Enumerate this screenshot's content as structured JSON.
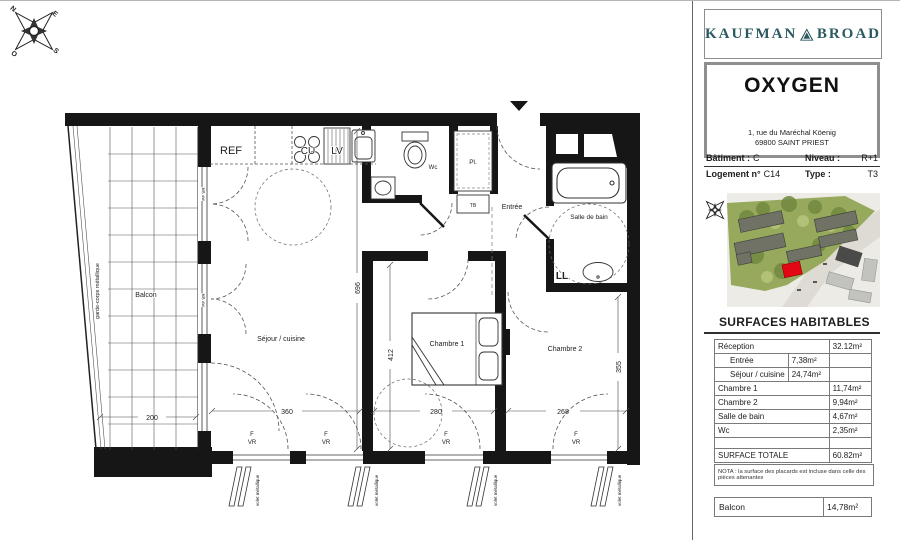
{
  "compass": {
    "n": "N",
    "e": "E",
    "s": "S",
    "o": "O"
  },
  "plan": {
    "rooms": {
      "sejour": "Séjour / cuisine",
      "chambre1": "Chambre 1",
      "chambre2": "Chambre 2",
      "salle_de_bain": "Salle de bain",
      "entree": "Entrée",
      "wc": "Wc",
      "balcon": "Balcon"
    },
    "kitchen": {
      "ref": "REF",
      "cu": "CU",
      "lv": "LV"
    },
    "fixtures": {
      "ll": "LL",
      "pl": "Pl.",
      "tb": "TB"
    },
    "window_labels": {
      "f": "F",
      "vr": "VR",
      "pf_vr": "PF VR",
      "volet": "volet métallique",
      "garde_corps": "garde-corps métallique"
    },
    "dims": {
      "balcon_w": "200",
      "sejour_w": "360",
      "sejour_h": "696",
      "ch1_w": "280",
      "ch1_h": "412",
      "ch2_w": "268",
      "ch2_h": "355"
    }
  },
  "panel": {
    "brand": {
      "left": "KAUFMAN",
      "right": "BROAD"
    },
    "residence": {
      "name": "OXYGEN",
      "address_line1": "1, rue du Maréchal Köenig",
      "address_line2": "69800 SAINT PRIEST"
    },
    "info": {
      "batiment_label": "Bâtiment :",
      "batiment_value": "C",
      "niveau_label": "Niveau :",
      "niveau_value": "R+1",
      "logement_label": "Logement n°",
      "logement_value": "C14",
      "type_label": "Type :",
      "type_value": "T3"
    },
    "surfaces": {
      "title": "SURFACES HABITABLES",
      "rows": [
        {
          "label": "Réception",
          "mid": "",
          "value": "32.12m²"
        },
        {
          "label": "Entrée",
          "mid": "7,38m²",
          "value": ""
        },
        {
          "label": "Séjour / cuisine",
          "mid": "24,74m²",
          "value": ""
        },
        {
          "label": "Chambre 1",
          "mid": "",
          "value": "11,74m²"
        },
        {
          "label": "Chambre 2",
          "mid": "",
          "value": "9,94m²"
        },
        {
          "label": "Salle de bain",
          "mid": "",
          "value": "4,67m²"
        },
        {
          "label": "Wc",
          "mid": "",
          "value": "2,35m²"
        },
        {
          "label": "",
          "mid": "",
          "value": ""
        },
        {
          "label": "SURFACE TOTALE",
          "mid": "",
          "value": "60.82m²"
        }
      ],
      "nota": "NOTA : la surface des placards est incluse dans celle des pièces attenantes",
      "balcon_label": "Balcon",
      "balcon_value": "14,78m²"
    },
    "colors": {
      "brand_teal": "#2a5a60",
      "highlight_red": "#e30613"
    }
  }
}
